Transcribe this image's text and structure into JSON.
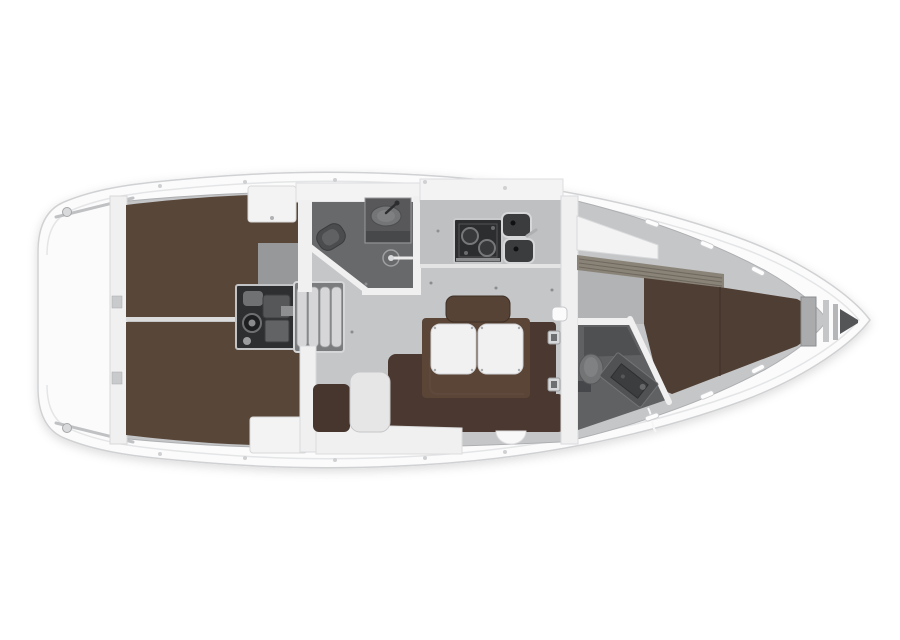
{
  "diagram": {
    "type": "yacht-interior-floor-plan",
    "orientation": "bow-right",
    "regions": [
      "stern-platform",
      "aft-berth-port",
      "aft-berth-starboard",
      "engine-compartment",
      "companionway-steps",
      "aft-head",
      "galley",
      "saloon",
      "saloon-table",
      "navigation-area",
      "forward-head",
      "forward-cabin-berth",
      "anchor-locker"
    ]
  },
  "colors": {
    "hull_white": "#fbfbfc",
    "hull_outline": "#d0d1d3",
    "deck_line": "#e4e5e6",
    "floor_gray": "#c5c6c8",
    "floor_dark_pocket": "#b2b3b5",
    "berth_brown": "#584639",
    "fwd_berth_brown": "#4f3e33",
    "sofa_brown": "#4a3831",
    "table_brown": "#5a4537",
    "backrest_brown": "#574336",
    "nav_seat_brown": "#47362e",
    "head_floor": "#68696b",
    "fwd_head_floor": "#606163",
    "wall_white": "#f0f0f1",
    "locker_white": "#f3f3f4",
    "counter_gray": "#bfc0c2",
    "appliance_dark": "#2c2d2f",
    "sink_dark": "#3b3c3e",
    "engine_dark": "#2e2f31",
    "steps_gray": "#d6d6d8",
    "steps_frame": "#7b7c7e",
    "fixture_gray": "#737476",
    "centerline": "#dcdcdd",
    "slat_band": "#8a8378",
    "leaf_white": "#f1f1f2",
    "stool_gray": "#e6e6e7",
    "frame_gray": "#aaabad",
    "surround_gray": "#97989a"
  }
}
